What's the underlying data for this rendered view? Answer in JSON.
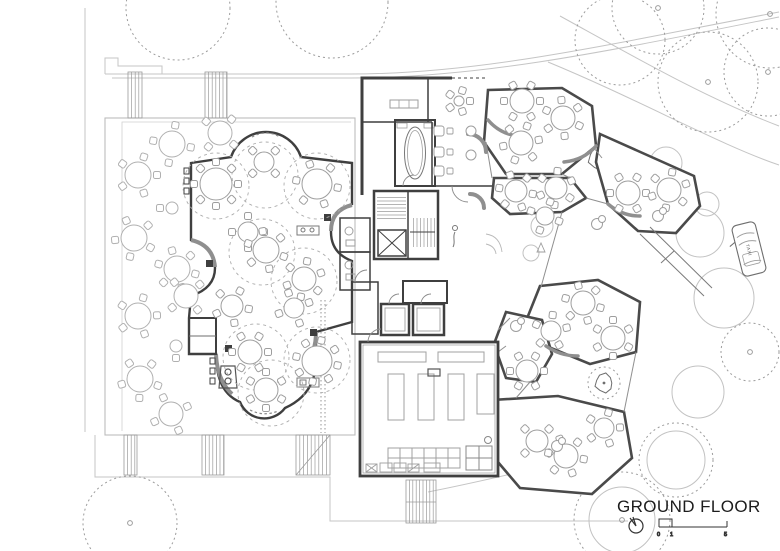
{
  "labels": {
    "title": "GROUND FLOOR",
    "taxi": "TAXI",
    "scale_ticks": [
      "0",
      "1",
      "5"
    ]
  },
  "colors": {
    "wall": "#3f3f3f",
    "wall_medium": "#6e6e6e",
    "accent_arc": "#8f8f8f",
    "furniture": "#9e9e9e",
    "furniture_light": "#b0b0b0",
    "site": "#c5c5c5",
    "tree": "#9c9c9c",
    "umbrella": "#adadad",
    "text": "#1c1c1c"
  },
  "plan": {
    "terrace_tables": [
      [
        172,
        144,
        13,
        4,
        10
      ],
      [
        220,
        133,
        12,
        4,
        40
      ],
      [
        138,
        175,
        13,
        5,
        0
      ],
      [
        134,
        238,
        13,
        5,
        30
      ],
      [
        177,
        269,
        13,
        6,
        15
      ],
      [
        186,
        296,
        12,
        4,
        50
      ],
      [
        138,
        316,
        13,
        5,
        70
      ],
      [
        140,
        379,
        13,
        5,
        20
      ],
      [
        171,
        414,
        12,
        4,
        65
      ],
      [
        172,
        208,
        6,
        1,
        180
      ],
      [
        176,
        346,
        6,
        1,
        90
      ]
    ],
    "hall_tables": [
      [
        216,
        184,
        16,
        8,
        0
      ],
      [
        264,
        162,
        10,
        4,
        45
      ],
      [
        317,
        184,
        15,
        6,
        10
      ],
      [
        248,
        232,
        10,
        4,
        0
      ],
      [
        266,
        250,
        13,
        6,
        20
      ],
      [
        304,
        279,
        12,
        6,
        40
      ],
      [
        232,
        306,
        11,
        5,
        10
      ],
      [
        294,
        308,
        10,
        4,
        70
      ],
      [
        250,
        352,
        12,
        6,
        0
      ],
      [
        317,
        361,
        15,
        8,
        12
      ],
      [
        266,
        390,
        12,
        6,
        30
      ]
    ],
    "hall_umbrellas": [
      [
        216,
        186
      ],
      [
        317,
        186
      ],
      [
        265,
        175
      ],
      [
        262,
        252
      ],
      [
        304,
        281
      ],
      [
        317,
        360
      ],
      [
        256,
        357
      ],
      [
        271,
        393
      ]
    ],
    "pavilion_tables": [
      [
        522,
        101,
        12,
        6,
        0
      ],
      [
        563,
        118,
        12,
        6,
        25
      ],
      [
        521,
        143,
        12,
        6,
        50
      ],
      [
        516,
        191,
        11,
        6,
        10
      ],
      [
        556,
        188,
        11,
        6,
        35
      ],
      [
        628,
        193,
        12,
        6,
        0
      ],
      [
        669,
        190,
        12,
        6,
        40
      ],
      [
        545,
        216,
        9,
        4,
        20
      ],
      [
        583,
        303,
        12,
        6,
        15
      ],
      [
        551,
        331,
        10,
        5,
        60
      ],
      [
        613,
        338,
        12,
        6,
        30
      ],
      [
        527,
        371,
        11,
        6,
        0
      ],
      [
        537,
        441,
        11,
        4,
        45
      ],
      [
        566,
        456,
        12,
        6,
        10
      ],
      [
        604,
        428,
        10,
        5,
        70
      ]
    ],
    "small_pair_tables": [
      [
        658,
        216
      ],
      [
        597,
        224
      ],
      [
        516,
        326
      ],
      [
        557,
        446
      ]
    ],
    "lounge_cluster": [
      [
        459,
        101,
        5,
        5,
        0
      ]
    ],
    "lounge_pairs": [
      [
        439,
        131
      ],
      [
        439,
        152
      ],
      [
        439,
        171
      ]
    ],
    "lounge_round_tables": [
      [
        471,
        131,
        5
      ],
      [
        471,
        155,
        5
      ]
    ],
    "courtyard_solid_trees": [
      [
        542,
        226,
        11
      ],
      [
        531,
        253,
        8
      ],
      [
        666,
        163,
        16
      ],
      [
        707,
        204,
        12
      ],
      [
        700,
        233,
        24
      ],
      [
        724,
        298,
        30
      ],
      [
        698,
        392,
        26
      ],
      [
        622,
        520,
        33
      ],
      [
        676,
        460,
        29
      ]
    ],
    "canopy_trees": [
      [
        178,
        8,
        52,
        0
      ],
      [
        332,
        2,
        56,
        0
      ],
      [
        620,
        40,
        45,
        0
      ],
      [
        658,
        8,
        46,
        1
      ],
      [
        770,
        14,
        54,
        1
      ],
      [
        708,
        82,
        50,
        1
      ],
      [
        768,
        72,
        44,
        1
      ],
      [
        750,
        352,
        29,
        1
      ],
      [
        130,
        523,
        47,
        1
      ],
      [
        622,
        520,
        48,
        1
      ],
      [
        676,
        460,
        37,
        0
      ],
      [
        604,
        383,
        16,
        0
      ]
    ],
    "poly_trees": [
      [
        600,
        158,
        13
      ],
      [
        604,
        383,
        10
      ]
    ]
  }
}
